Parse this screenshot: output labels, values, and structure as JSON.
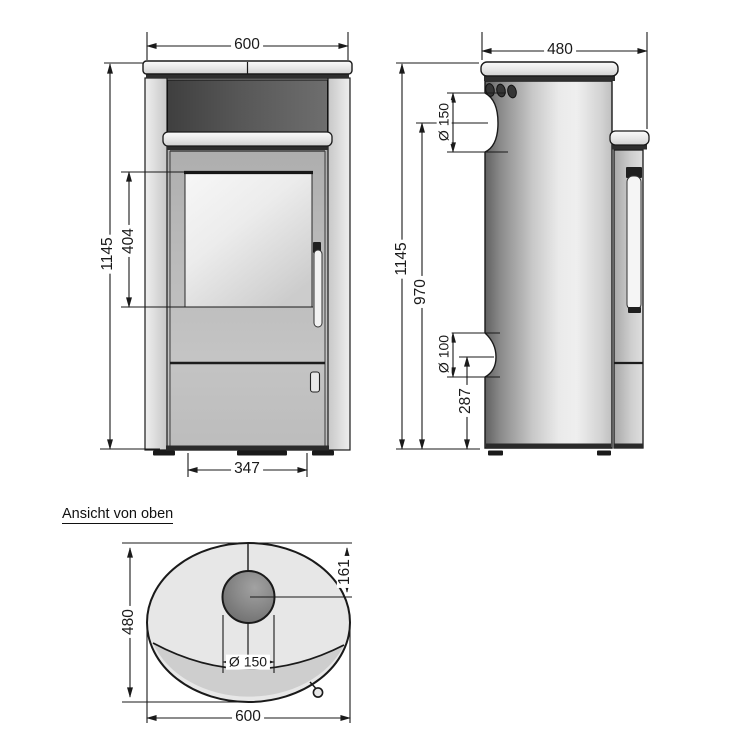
{
  "drawing": {
    "top_view_title": "Ansicht von oben",
    "front_view": {
      "width_mm": "600",
      "height_mm": "1145",
      "glass_height_mm": "404",
      "door_width_mm": "347"
    },
    "side_view": {
      "depth_mm": "480",
      "height_mm": "1145",
      "flue_center_height_mm": "970",
      "flue_diameter": "Ø 150",
      "intake_diameter": "Ø 100",
      "intake_center_height_mm": "287"
    },
    "top_view": {
      "depth_mm": "480",
      "width_mm": "600",
      "flue_offset_rear_mm": "161",
      "flue_diameter": "Ø 150"
    },
    "colors": {
      "line": "#1a1a1a",
      "background": "#ffffff",
      "body_light": "#e7e7e7",
      "body_dark": "#4a4a4a"
    }
  }
}
